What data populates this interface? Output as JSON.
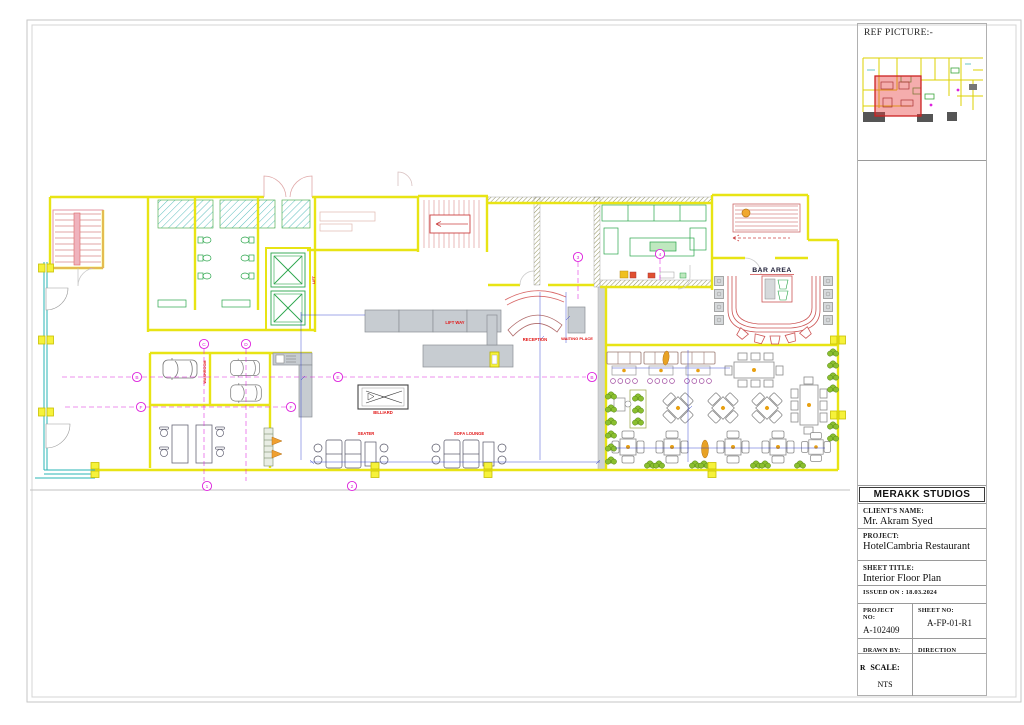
{
  "colors": {
    "wall_yellow": "#e8e414",
    "exterior_cyan": "#2ab4b4",
    "fixture_green": "#2aa54a",
    "stair_red": "#d97f7f",
    "label_red": "#e11414",
    "grid_magenta": "#dd22dd",
    "dim_blue": "#2233cc",
    "counter_gray": "#c7ccd1",
    "plant_green": "#8abf2e",
    "bar_red": "#cc5555",
    "highlight_red": "#cc2222"
  },
  "title_block": {
    "ref_label": "REF PICTURE:-",
    "studio": "MERAKK STUDIOS",
    "client_label": "CLIENT'S NAME:",
    "client_name": "Mr. Akram Syed",
    "project_label": "PROJECT:",
    "project_name": "HotelCambria Restaurant",
    "sheet_title_label": "SHEET TITLE:",
    "sheet_title": "Interior Floor Plan",
    "issued_on": "ISSUED ON : 18.03.2024",
    "project_no_label": "PROJECT NO:",
    "project_no": "A-102409",
    "sheet_no_label": "SHEET NO:",
    "sheet_no": "A-FP-01-R1",
    "drawn_by_label": "DRAWN BY:",
    "drawn_by": "R",
    "direction_label": "DIRECTION",
    "scale_label": "SCALE:",
    "scale_value": "NTS"
  },
  "plan": {
    "labels": {
      "bar_area": "BAR AREA",
      "reception": "RECEPTION",
      "lift_way": "LIFT WAY",
      "waiting_place": "WAITING PLACE",
      "seater": "SEATER",
      "sofa_lounge": "SOFA LOUNGE",
      "billiard": "BILLIARD",
      "washroom": "WASHROOM",
      "lift": "LIFT"
    },
    "grid_bubbles": [
      {
        "label": "B"
      },
      {
        "label": "F"
      },
      {
        "label": "F"
      },
      {
        "label": "B"
      },
      {
        "label": "C"
      },
      {
        "label": "D"
      },
      {
        "label": "E"
      },
      {
        "label": "3"
      },
      {
        "label": "4"
      },
      {
        "label": "1"
      },
      {
        "label": "2"
      }
    ]
  }
}
